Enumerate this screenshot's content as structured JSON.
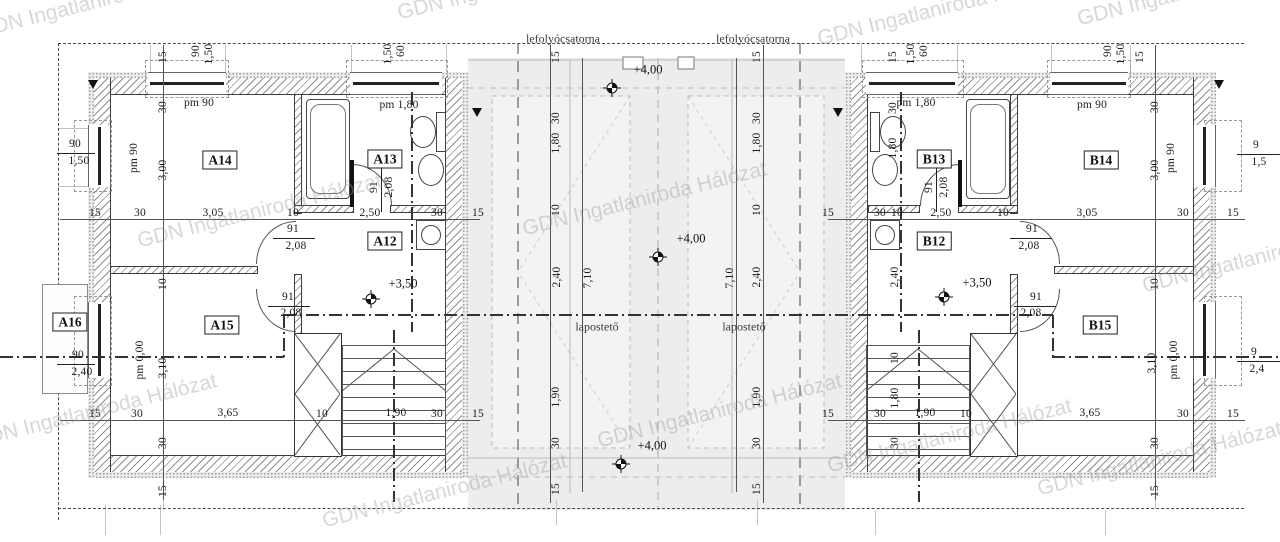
{
  "watermark": {
    "text": "GDN Ingatlaniroda Hálózat"
  },
  "watermarks": [
    {
      "x": -25,
      "y": 20
    },
    {
      "x": 395,
      "y": 2
    },
    {
      "x": 815,
      "y": 28
    },
    {
      "x": 1075,
      "y": 8
    },
    {
      "x": 135,
      "y": 230
    },
    {
      "x": 520,
      "y": 218
    },
    {
      "x": 1140,
      "y": 275
    },
    {
      "x": -30,
      "y": 430
    },
    {
      "x": 595,
      "y": 430
    },
    {
      "x": 825,
      "y": 455
    },
    {
      "x": 320,
      "y": 510
    },
    {
      "x": 1035,
      "y": 478
    }
  ],
  "rooms": [
    {
      "id": "A14",
      "x": 220,
      "y": 160
    },
    {
      "id": "A13",
      "x": 385,
      "y": 159
    },
    {
      "id": "A12",
      "x": 385,
      "y": 241
    },
    {
      "id": "A15",
      "x": 222,
      "y": 325
    },
    {
      "id": "A16",
      "x": 70,
      "y": 322
    },
    {
      "id": "B13",
      "x": 934,
      "y": 159
    },
    {
      "id": "B14",
      "x": 1101,
      "y": 160
    },
    {
      "id": "B12",
      "x": 934,
      "y": 241
    },
    {
      "id": "B15",
      "x": 1100,
      "y": 325
    }
  ],
  "notes": [
    {
      "t": "lefolyócsatorna",
      "x": 563,
      "y": 39
    },
    {
      "t": "lefolyócsatorna",
      "x": 753,
      "y": 39
    },
    {
      "t": "lapostető",
      "x": 597,
      "y": 327
    },
    {
      "t": "lapostető",
      "x": 744,
      "y": 327
    }
  ],
  "levels": [
    {
      "t": "+4,00",
      "x": 648,
      "y": 70
    },
    {
      "t": "+4,00",
      "x": 691,
      "y": 239
    },
    {
      "t": "+4,00",
      "x": 652,
      "y": 446
    },
    {
      "t": "+3,50",
      "x": 403,
      "y": 284
    },
    {
      "t": "+3,50",
      "x": 977,
      "y": 283
    }
  ],
  "benchmarks": [
    {
      "x": 612,
      "y": 88
    },
    {
      "x": 658,
      "y": 257
    },
    {
      "x": 621,
      "y": 464
    },
    {
      "x": 371,
      "y": 299
    },
    {
      "x": 944,
      "y": 297
    }
  ],
  "dims": [
    {
      "t": "15",
      "x": 163,
      "y": 57,
      "r": 1
    },
    {
      "t": "90",
      "x": 196,
      "y": 51,
      "r": 1
    },
    {
      "t": "1,50",
      "x": 209,
      "y": 54,
      "r": 1
    },
    {
      "t": "1,50",
      "x": 388,
      "y": 54,
      "r": 1
    },
    {
      "t": "60",
      "x": 401,
      "y": 51,
      "r": 1
    },
    {
      "t": "15",
      "x": 893,
      "y": 57,
      "r": 1
    },
    {
      "t": "1,50",
      "x": 911,
      "y": 54,
      "r": 1
    },
    {
      "t": "60",
      "x": 924,
      "y": 51,
      "r": 1
    },
    {
      "t": "90",
      "x": 1108,
      "y": 51,
      "r": 1
    },
    {
      "t": "1,50",
      "x": 1121,
      "y": 54,
      "r": 1
    },
    {
      "t": "15",
      "x": 1140,
      "y": 57,
      "r": 1
    },
    {
      "t": "15",
      "x": 556,
      "y": 57,
      "r": 1
    },
    {
      "t": "30",
      "x": 556,
      "y": 118,
      "r": 1
    },
    {
      "t": "1,80",
      "x": 556,
      "y": 143,
      "r": 1
    },
    {
      "t": "10",
      "x": 556,
      "y": 210,
      "r": 1
    },
    {
      "t": "2,40",
      "x": 557,
      "y": 277,
      "r": 1
    },
    {
      "t": "1,90",
      "x": 556,
      "y": 397,
      "r": 1
    },
    {
      "t": "30",
      "x": 556,
      "y": 443,
      "r": 1
    },
    {
      "t": "15",
      "x": 556,
      "y": 489,
      "r": 1
    },
    {
      "t": "7,10",
      "x": 588,
      "y": 278,
      "r": 1
    },
    {
      "t": "15",
      "x": 757,
      "y": 57,
      "r": 1
    },
    {
      "t": "30",
      "x": 757,
      "y": 118,
      "r": 1
    },
    {
      "t": "1,80",
      "x": 757,
      "y": 143,
      "r": 1
    },
    {
      "t": "10",
      "x": 757,
      "y": 210,
      "r": 1
    },
    {
      "t": "2,40",
      "x": 757,
      "y": 277,
      "r": 1
    },
    {
      "t": "1,90",
      "x": 757,
      "y": 397,
      "r": 1
    },
    {
      "t": "30",
      "x": 757,
      "y": 443,
      "r": 1
    },
    {
      "t": "15",
      "x": 757,
      "y": 489,
      "r": 1
    },
    {
      "t": "7,10",
      "x": 730,
      "y": 278,
      "r": 1
    },
    {
      "t": "30",
      "x": 163,
      "y": 107,
      "r": 1
    },
    {
      "t": "3,00",
      "x": 163,
      "y": 170,
      "r": 1
    },
    {
      "t": "10",
      "x": 163,
      "y": 284,
      "r": 1
    },
    {
      "t": "3,10",
      "x": 163,
      "y": 368,
      "r": 1
    },
    {
      "t": "30",
      "x": 163,
      "y": 443,
      "r": 1
    },
    {
      "t": "15",
      "x": 163,
      "y": 491,
      "r": 1
    },
    {
      "t": "30",
      "x": 1155,
      "y": 107,
      "r": 1
    },
    {
      "t": "3,00",
      "x": 1155,
      "y": 170,
      "r": 1
    },
    {
      "t": "10",
      "x": 1155,
      "y": 284,
      "r": 1
    },
    {
      "t": "3,10",
      "x": 1152,
      "y": 363,
      "r": 1
    },
    {
      "t": "30",
      "x": 1155,
      "y": 443,
      "r": 1
    },
    {
      "t": "15",
      "x": 1155,
      "y": 491,
      "r": 1
    },
    {
      "t": "30",
      "x": 893,
      "y": 108,
      "r": 1
    },
    {
      "t": "1,80",
      "x": 893,
      "y": 148,
      "r": 1
    },
    {
      "t": "2,40",
      "x": 895,
      "y": 277,
      "r": 1
    },
    {
      "t": "10",
      "x": 895,
      "y": 358,
      "r": 1
    },
    {
      "t": "1,80",
      "x": 895,
      "y": 398,
      "r": 1
    },
    {
      "t": "30",
      "x": 895,
      "y": 443,
      "r": 1
    },
    {
      "t": "15",
      "x": 95,
      "y": 213
    },
    {
      "t": "30",
      "x": 140,
      "y": 213
    },
    {
      "t": "3,05",
      "x": 213,
      "y": 213
    },
    {
      "t": "10",
      "x": 293,
      "y": 213
    },
    {
      "t": "2,50",
      "x": 370,
      "y": 213
    },
    {
      "t": "30",
      "x": 437,
      "y": 213
    },
    {
      "t": "15",
      "x": 478,
      "y": 213
    },
    {
      "t": "15",
      "x": 95,
      "y": 414
    },
    {
      "t": "30",
      "x": 137,
      "y": 414
    },
    {
      "t": "3,65",
      "x": 228,
      "y": 413
    },
    {
      "t": "10",
      "x": 322,
      "y": 414
    },
    {
      "t": "1,90",
      "x": 396,
      "y": 413
    },
    {
      "t": "30",
      "x": 437,
      "y": 414
    },
    {
      "t": "15",
      "x": 478,
      "y": 414
    },
    {
      "t": "15",
      "x": 828,
      "y": 213
    },
    {
      "t": "30",
      "x": 880,
      "y": 213
    },
    {
      "t": "10",
      "x": 897,
      "y": 213
    },
    {
      "t": "2,50",
      "x": 941,
      "y": 213
    },
    {
      "t": "10",
      "x": 1003,
      "y": 213
    },
    {
      "t": "3,05",
      "x": 1087,
      "y": 213
    },
    {
      "t": "30",
      "x": 1183,
      "y": 213
    },
    {
      "t": "15",
      "x": 1233,
      "y": 213
    },
    {
      "t": "15",
      "x": 828,
      "y": 414
    },
    {
      "t": "30",
      "x": 880,
      "y": 414
    },
    {
      "t": "1,90",
      "x": 925,
      "y": 413
    },
    {
      "t": "10",
      "x": 966,
      "y": 414
    },
    {
      "t": "3,65",
      "x": 1090,
      "y": 413
    },
    {
      "t": "30",
      "x": 1183,
      "y": 414
    },
    {
      "t": "15",
      "x": 1233,
      "y": 414
    },
    {
      "t": "91",
      "x": 293,
      "y": 229
    },
    {
      "t": "2,08",
      "x": 296,
      "y": 246
    },
    {
      "t": "91",
      "x": 288,
      "y": 297
    },
    {
      "t": "2,08",
      "x": 291,
      "y": 313
    },
    {
      "t": "91",
      "x": 374,
      "y": 187,
      "r": 1
    },
    {
      "t": "2,08",
      "x": 389,
      "y": 187,
      "r": 1
    },
    {
      "t": "91",
      "x": 929,
      "y": 187,
      "r": 1
    },
    {
      "t": "2,08",
      "x": 944,
      "y": 187,
      "r": 1
    },
    {
      "t": "91",
      "x": 1032,
      "y": 229
    },
    {
      "t": "2,08",
      "x": 1029,
      "y": 246
    },
    {
      "t": "91",
      "x": 1036,
      "y": 297
    },
    {
      "t": "2,08",
      "x": 1031,
      "y": 313
    },
    {
      "t": "pm 90",
      "x": 199,
      "y": 103
    },
    {
      "t": "pm 1,80",
      "x": 399,
      "y": 105
    },
    {
      "t": "pm 90",
      "x": 134,
      "y": 158,
      "r": 1
    },
    {
      "t": "pm 0,00",
      "x": 140,
      "y": 360,
      "r": 1
    },
    {
      "t": "pm 1,80",
      "x": 916,
      "y": 103
    },
    {
      "t": "pm 90",
      "x": 1092,
      "y": 105
    },
    {
      "t": "pm 90",
      "x": 1171,
      "y": 158,
      "r": 1
    },
    {
      "t": "pm 0,00",
      "x": 1174,
      "y": 360,
      "r": 1
    },
    {
      "t": "90",
      "x": 75,
      "y": 144
    },
    {
      "t": "1,50",
      "x": 79,
      "y": 161
    },
    {
      "t": "90",
      "x": 78,
      "y": 355
    },
    {
      "t": "2,40",
      "x": 82,
      "y": 372
    },
    {
      "t": "9",
      "x": 1256,
      "y": 145
    },
    {
      "t": "1,5",
      "x": 1259,
      "y": 162
    },
    {
      "t": "9",
      "x": 1254,
      "y": 352
    },
    {
      "t": "2,4",
      "x": 1257,
      "y": 369
    }
  ]
}
